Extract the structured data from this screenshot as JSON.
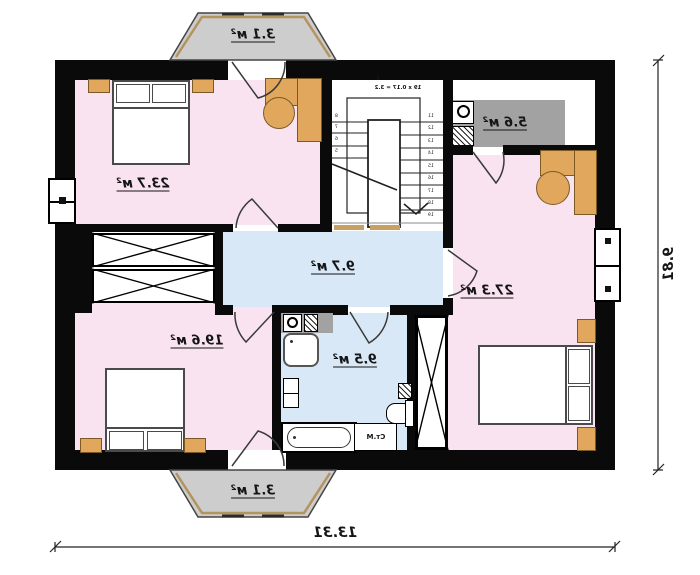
{
  "plan": {
    "rooms": [
      {
        "id": "balcony-top",
        "label": "3.1 м²"
      },
      {
        "id": "bedroom-top-left",
        "label": "23.7 м²"
      },
      {
        "id": "utility",
        "label": "5.6 м²"
      },
      {
        "id": "bedroom-right",
        "label": "27.3 м²"
      },
      {
        "id": "hallway",
        "label": "9.7 м²"
      },
      {
        "id": "bedroom-bottom-left",
        "label": "19.6 м²"
      },
      {
        "id": "bathroom",
        "label": "9.5 м²"
      },
      {
        "id": "balcony-bottom",
        "label": "3.1 м²"
      }
    ],
    "dimensions": {
      "width": "13.31",
      "height": "9.81"
    },
    "stairs": {
      "mark": "2",
      "formula": "19 x 0.17 = 3.2",
      "steps_right": [
        "11",
        "12",
        "13",
        "14",
        "15",
        "16",
        "17",
        "18",
        "19"
      ],
      "steps_left": [
        "8",
        "7",
        "6",
        "5"
      ]
    },
    "annotations": {
      "washing_machine": "Ст.М"
    },
    "colors": {
      "wall": "#0a0a0a",
      "bedroom_pink": "#f9e3f1",
      "wet_blue": "#d8e8f7",
      "balcony_gray": "#cdcdcd",
      "counter_gray": "#a2a2a2",
      "furniture_wood": "#e0a75d"
    }
  }
}
